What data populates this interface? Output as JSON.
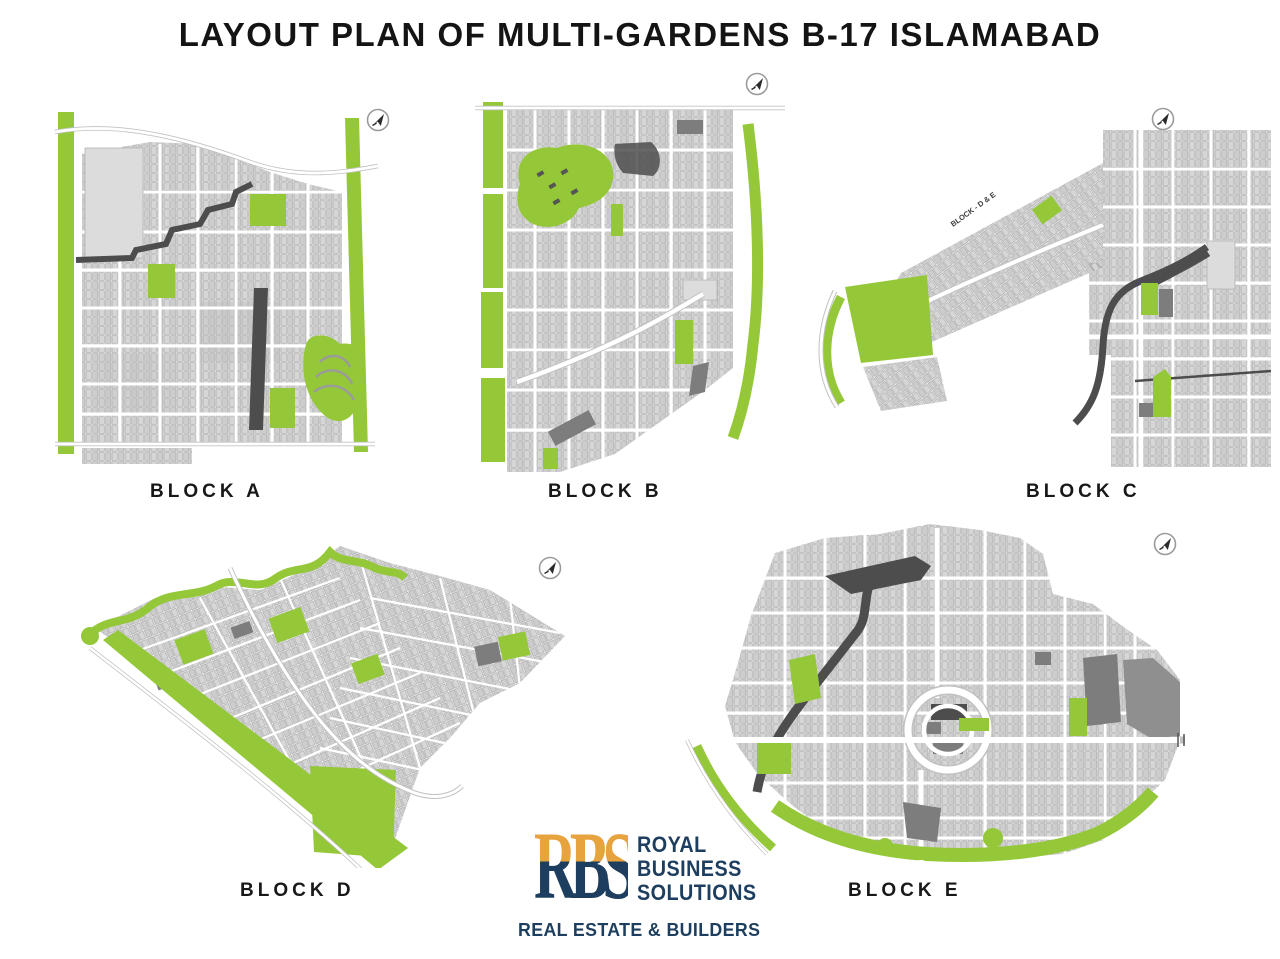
{
  "page": {
    "title": "LAYOUT PLAN OF MULTI-GARDENS B-17 ISLAMABAD"
  },
  "colors": {
    "green": "#94c838",
    "dark": "#4d4d4d",
    "mid_gray": "#7d7d7d",
    "light_area": "#dcdcdc",
    "road_casing": "#c2c2c2",
    "ink": "#141414",
    "navy": "#1d3e5e",
    "orange": "#e7a33e"
  },
  "blocks": [
    {
      "id": "a",
      "label": "BLOCK A"
    },
    {
      "id": "b",
      "label": "BLOCK B"
    },
    {
      "id": "c",
      "label": "BLOCK C",
      "road_label": "BLOCK - D & E"
    },
    {
      "id": "d",
      "label": "BLOCK D"
    },
    {
      "id": "e",
      "label": "BLOCK E"
    }
  ],
  "logo": {
    "monogram": "RBS",
    "line1": "ROYAL",
    "line2": "BUSINESS",
    "line3": "SOLUTIONS",
    "tagline": "REAL ESTATE & BUILDERS"
  }
}
